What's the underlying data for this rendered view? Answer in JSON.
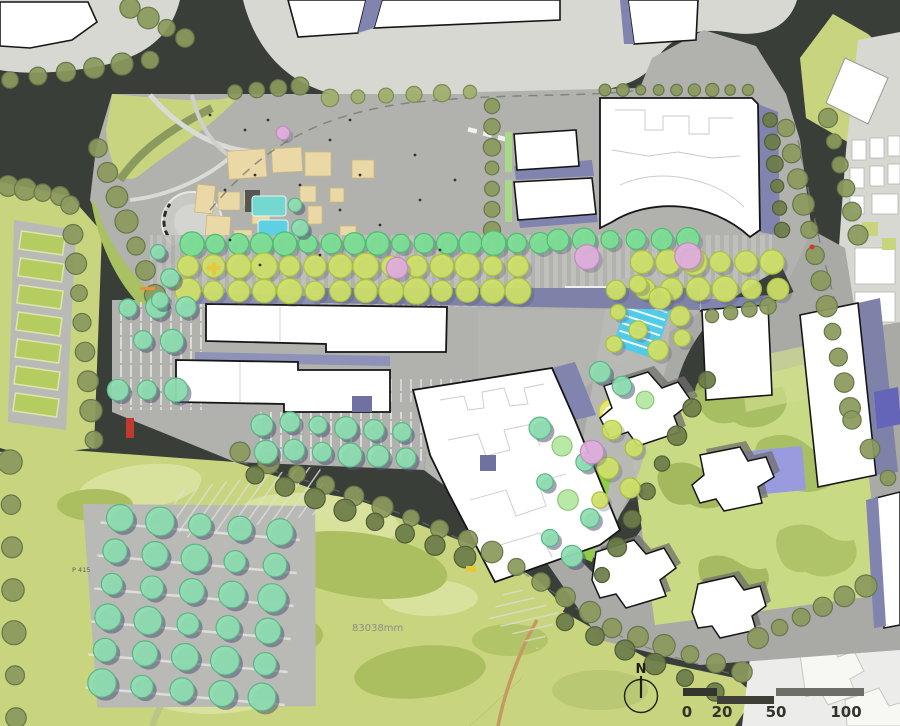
{
  "annotations": {
    "north_label": "N",
    "dimension_label": "83038mm",
    "parking_label": "P 415"
  },
  "scale_bar": {
    "ticks": [
      "0",
      "20",
      "50",
      "100"
    ]
  },
  "palette": {
    "road": "#3a3e38",
    "parcel_gray": "#d7d8d2",
    "site_paving": "#b1b1ae",
    "lawn": "#c8d47e",
    "lawn_light": "#d9e29c",
    "lawn_dark": "#abbf60",
    "building_fill": "#ffffff",
    "building_outline": "#161616",
    "shadow_purple": "#8184ae",
    "shadow_purple_dark": "#6f72a0",
    "shadow_purple_light": "#9a9dc2",
    "water_teal": "#74d8d0",
    "water_cascade": "#52cbe9",
    "tan_paving": "#ead9a6",
    "accent_red": "#c03a2e",
    "accent_yellow": "#e8c83a",
    "accent_orange": "#e8923a",
    "scalebar_dark": "#35352f",
    "scalebar_gray": "#6e6e68",
    "trees": {
      "olive": {
        "fill": "#8b9a5e",
        "edge": "#67774a"
      },
      "paleolive": {
        "fill": "#9fae6c",
        "edge": "#7d8c54"
      },
      "darkolive": {
        "fill": "#6d7d49",
        "edge": "#525f36"
      },
      "mint": {
        "fill": "#8fdfb2",
        "edge": "#5bb487",
        "shadow": "#50507288"
      },
      "bright": {
        "fill": "#7ce094",
        "edge": "#49bf70",
        "shadow": "#50507255"
      },
      "yellow": {
        "fill": "#cfe168",
        "edge": "#a9c23e",
        "shadow": "#50507244"
      },
      "pink": {
        "fill": "#e0aedd",
        "edge": "#c788c3",
        "shadow": "#50507244"
      },
      "pale": {
        "fill": "#b5e6a0",
        "edge": "#8cc878"
      }
    }
  },
  "trees": {
    "rows": [
      {
        "x1": 10,
        "y1": 80,
        "x2": 150,
        "y2": 60,
        "n": 6,
        "r": 10,
        "t": "olive"
      },
      {
        "x1": 130,
        "y1": 8,
        "x2": 185,
        "y2": 38,
        "n": 4,
        "r": 10,
        "t": "olive"
      },
      {
        "x1": 235,
        "y1": 92,
        "x2": 300,
        "y2": 86,
        "n": 4,
        "r": 8,
        "t": "olive"
      },
      {
        "x1": 330,
        "y1": 98,
        "x2": 470,
        "y2": 92,
        "n": 6,
        "r": 8,
        "t": "paleolive"
      },
      {
        "x1": 605,
        "y1": 90,
        "x2": 748,
        "y2": 90,
        "n": 9,
        "r": 6,
        "t": "olive"
      },
      {
        "x1": 786,
        "y1": 128,
        "x2": 850,
        "y2": 408,
        "n": 12,
        "r": 10,
        "t": "olive"
      },
      {
        "x1": 828,
        "y1": 118,
        "x2": 858,
        "y2": 235,
        "n": 6,
        "r": 9,
        "t": "olive"
      },
      {
        "x1": 492,
        "y1": 106,
        "x2": 492,
        "y2": 230,
        "n": 7,
        "r": 8,
        "t": "olive"
      },
      {
        "x1": 98,
        "y1": 148,
        "x2": 155,
        "y2": 295,
        "n": 7,
        "r": 11,
        "t": "olive"
      },
      {
        "x1": 8,
        "y1": 186,
        "x2": 60,
        "y2": 196,
        "n": 4,
        "r": 10,
        "t": "olive"
      },
      {
        "x1": 70,
        "y1": 205,
        "x2": 94,
        "y2": 440,
        "n": 9,
        "r": 10,
        "t": "olive"
      },
      {
        "x1": 10,
        "y1": 462,
        "x2": 16,
        "y2": 718,
        "n": 7,
        "r": 11,
        "t": "olive"
      },
      {
        "x1": 240,
        "y1": 452,
        "x2": 468,
        "y2": 540,
        "n": 9,
        "r": 10,
        "t": "olive"
      },
      {
        "x1": 255,
        "y1": 475,
        "x2": 465,
        "y2": 557,
        "n": 8,
        "r": 10,
        "t": "darkolive"
      },
      {
        "x1": 492,
        "y1": 552,
        "x2": 590,
        "y2": 612,
        "n": 5,
        "r": 10,
        "t": "olive"
      },
      {
        "x1": 612,
        "y1": 628,
        "x2": 742,
        "y2": 672,
        "n": 6,
        "r": 10,
        "t": "olive"
      },
      {
        "x1": 565,
        "y1": 622,
        "x2": 715,
        "y2": 692,
        "n": 6,
        "r": 10,
        "t": "darkolive"
      },
      {
        "x1": 758,
        "y1": 638,
        "x2": 866,
        "y2": 586,
        "n": 6,
        "r": 10,
        "t": "olive"
      },
      {
        "x1": 707,
        "y1": 380,
        "x2": 602,
        "y2": 575,
        "n": 8,
        "r": 9,
        "t": "darkolive"
      },
      {
        "x1": 712,
        "y1": 316,
        "x2": 768,
        "y2": 306,
        "n": 4,
        "r": 8,
        "t": "olive"
      },
      {
        "x1": 852,
        "y1": 420,
        "x2": 888,
        "y2": 478,
        "n": 3,
        "r": 9,
        "t": "olive"
      },
      {
        "x1": 770,
        "y1": 120,
        "x2": 782,
        "y2": 230,
        "n": 6,
        "r": 8,
        "t": "darkolive"
      },
      {
        "x1": 192,
        "y1": 244,
        "x2": 540,
        "y2": 243,
        "n": 16,
        "r": 11,
        "t": "bright"
      },
      {
        "x1": 558,
        "y1": 240,
        "x2": 688,
        "y2": 239,
        "n": 6,
        "r": 11,
        "t": "bright"
      },
      {
        "x1": 188,
        "y1": 266,
        "x2": 518,
        "y2": 266,
        "n": 14,
        "r": 12,
        "t": "yellow"
      },
      {
        "x1": 188,
        "y1": 291,
        "x2": 518,
        "y2": 291,
        "n": 14,
        "r": 12,
        "t": "yellow"
      },
      {
        "x1": 642,
        "y1": 262,
        "x2": 772,
        "y2": 262,
        "n": 6,
        "r": 12,
        "t": "yellow"
      },
      {
        "x1": 645,
        "y1": 289,
        "x2": 778,
        "y2": 289,
        "n": 6,
        "r": 12,
        "t": "yellow"
      },
      {
        "x1": 120,
        "y1": 518,
        "x2": 280,
        "y2": 532,
        "n": 5,
        "r": 13,
        "t": "mint"
      },
      {
        "x1": 115,
        "y1": 551,
        "x2": 275,
        "y2": 565,
        "n": 5,
        "r": 13,
        "t": "mint"
      },
      {
        "x1": 112,
        "y1": 584,
        "x2": 272,
        "y2": 598,
        "n": 5,
        "r": 13,
        "t": "mint"
      },
      {
        "x1": 108,
        "y1": 617,
        "x2": 268,
        "y2": 631,
        "n": 5,
        "r": 13,
        "t": "mint"
      },
      {
        "x1": 105,
        "y1": 650,
        "x2": 265,
        "y2": 664,
        "n": 5,
        "r": 13,
        "t": "mint"
      },
      {
        "x1": 102,
        "y1": 683,
        "x2": 262,
        "y2": 697,
        "n": 5,
        "r": 13,
        "t": "mint"
      }
    ],
    "singles": [
      {
        "x": 128,
        "y": 308,
        "r": 11,
        "t": "mint"
      },
      {
        "x": 157,
        "y": 307,
        "r": 11,
        "t": "mint"
      },
      {
        "x": 186,
        "y": 307,
        "r": 11,
        "t": "mint"
      },
      {
        "x": 143,
        "y": 340,
        "r": 11,
        "t": "mint"
      },
      {
        "x": 172,
        "y": 341,
        "r": 11,
        "t": "mint"
      },
      {
        "x": 118,
        "y": 390,
        "r": 11,
        "t": "mint"
      },
      {
        "x": 147,
        "y": 390,
        "r": 11,
        "t": "mint"
      },
      {
        "x": 176,
        "y": 390,
        "r": 11,
        "t": "mint"
      },
      {
        "x": 262,
        "y": 425,
        "r": 11,
        "t": "mint"
      },
      {
        "x": 290,
        "y": 422,
        "r": 11,
        "t": "mint"
      },
      {
        "x": 318,
        "y": 425,
        "r": 11,
        "t": "mint"
      },
      {
        "x": 346,
        "y": 428,
        "r": 11,
        "t": "mint"
      },
      {
        "x": 374,
        "y": 430,
        "r": 11,
        "t": "mint"
      },
      {
        "x": 402,
        "y": 432,
        "r": 11,
        "t": "mint"
      },
      {
        "x": 266,
        "y": 452,
        "r": 11,
        "t": "mint"
      },
      {
        "x": 294,
        "y": 450,
        "r": 11,
        "t": "mint"
      },
      {
        "x": 322,
        "y": 452,
        "r": 11,
        "t": "mint"
      },
      {
        "x": 350,
        "y": 455,
        "r": 11,
        "t": "mint"
      },
      {
        "x": 378,
        "y": 456,
        "r": 11,
        "t": "mint"
      },
      {
        "x": 406,
        "y": 458,
        "r": 11,
        "t": "mint"
      },
      {
        "x": 158,
        "y": 252,
        "r": 9,
        "t": "mint"
      },
      {
        "x": 170,
        "y": 278,
        "r": 9,
        "t": "mint"
      },
      {
        "x": 160,
        "y": 300,
        "r": 9,
        "t": "mint"
      },
      {
        "x": 295,
        "y": 205,
        "r": 8,
        "t": "mint"
      },
      {
        "x": 300,
        "y": 228,
        "r": 8,
        "t": "mint"
      },
      {
        "x": 616,
        "y": 290,
        "r": 10,
        "t": "yellow"
      },
      {
        "x": 638,
        "y": 284,
        "r": 10,
        "t": "yellow"
      },
      {
        "x": 660,
        "y": 298,
        "r": 10,
        "t": "yellow"
      },
      {
        "x": 680,
        "y": 316,
        "r": 10,
        "t": "yellow"
      },
      {
        "x": 638,
        "y": 330,
        "r": 10,
        "t": "yellow"
      },
      {
        "x": 614,
        "y": 344,
        "r": 10,
        "t": "yellow"
      },
      {
        "x": 658,
        "y": 350,
        "r": 10,
        "t": "yellow"
      },
      {
        "x": 682,
        "y": 338,
        "r": 9,
        "t": "yellow"
      },
      {
        "x": 618,
        "y": 312,
        "r": 9,
        "t": "yellow"
      },
      {
        "x": 600,
        "y": 372,
        "r": 10,
        "t": "mint"
      },
      {
        "x": 622,
        "y": 386,
        "r": 10,
        "t": "mint"
      },
      {
        "x": 645,
        "y": 400,
        "r": 10,
        "t": "pale"
      },
      {
        "x": 540,
        "y": 428,
        "r": 10,
        "t": "mint"
      },
      {
        "x": 562,
        "y": 446,
        "r": 10,
        "t": "pale"
      },
      {
        "x": 585,
        "y": 462,
        "r": 10,
        "t": "mint"
      },
      {
        "x": 545,
        "y": 482,
        "r": 10,
        "t": "mint"
      },
      {
        "x": 568,
        "y": 500,
        "r": 10,
        "t": "pale"
      },
      {
        "x": 590,
        "y": 518,
        "r": 10,
        "t": "mint"
      },
      {
        "x": 550,
        "y": 538,
        "r": 10,
        "t": "mint"
      },
      {
        "x": 572,
        "y": 556,
        "r": 10,
        "t": "mint"
      },
      {
        "x": 612,
        "y": 430,
        "r": 10,
        "t": "yellow"
      },
      {
        "x": 634,
        "y": 448,
        "r": 10,
        "t": "yellow"
      },
      {
        "x": 608,
        "y": 468,
        "r": 10,
        "t": "yellow"
      },
      {
        "x": 630,
        "y": 488,
        "r": 10,
        "t": "yellow"
      },
      {
        "x": 600,
        "y": 500,
        "r": 9,
        "t": "yellow"
      },
      {
        "x": 397,
        "y": 268,
        "r": 13,
        "t": "pink"
      },
      {
        "x": 587,
        "y": 257,
        "r": 12,
        "t": "pink"
      },
      {
        "x": 688,
        "y": 256,
        "r": 14,
        "t": "pink"
      },
      {
        "x": 283,
        "y": 133,
        "r": 8,
        "t": "pink"
      },
      {
        "x": 592,
        "y": 452,
        "r": 11,
        "t": "pink"
      }
    ]
  },
  "plaza_dots": [
    [
      210,
      115
    ],
    [
      245,
      130
    ],
    [
      268,
      120
    ],
    [
      330,
      140
    ],
    [
      360,
      175
    ],
    [
      300,
      185
    ],
    [
      255,
      175
    ],
    [
      225,
      190
    ],
    [
      340,
      210
    ],
    [
      380,
      225
    ],
    [
      420,
      200
    ],
    [
      440,
      250
    ],
    [
      320,
      255
    ],
    [
      260,
      265
    ],
    [
      230,
      240
    ],
    [
      415,
      155
    ],
    [
      455,
      180
    ],
    [
      350,
      120
    ]
  ]
}
